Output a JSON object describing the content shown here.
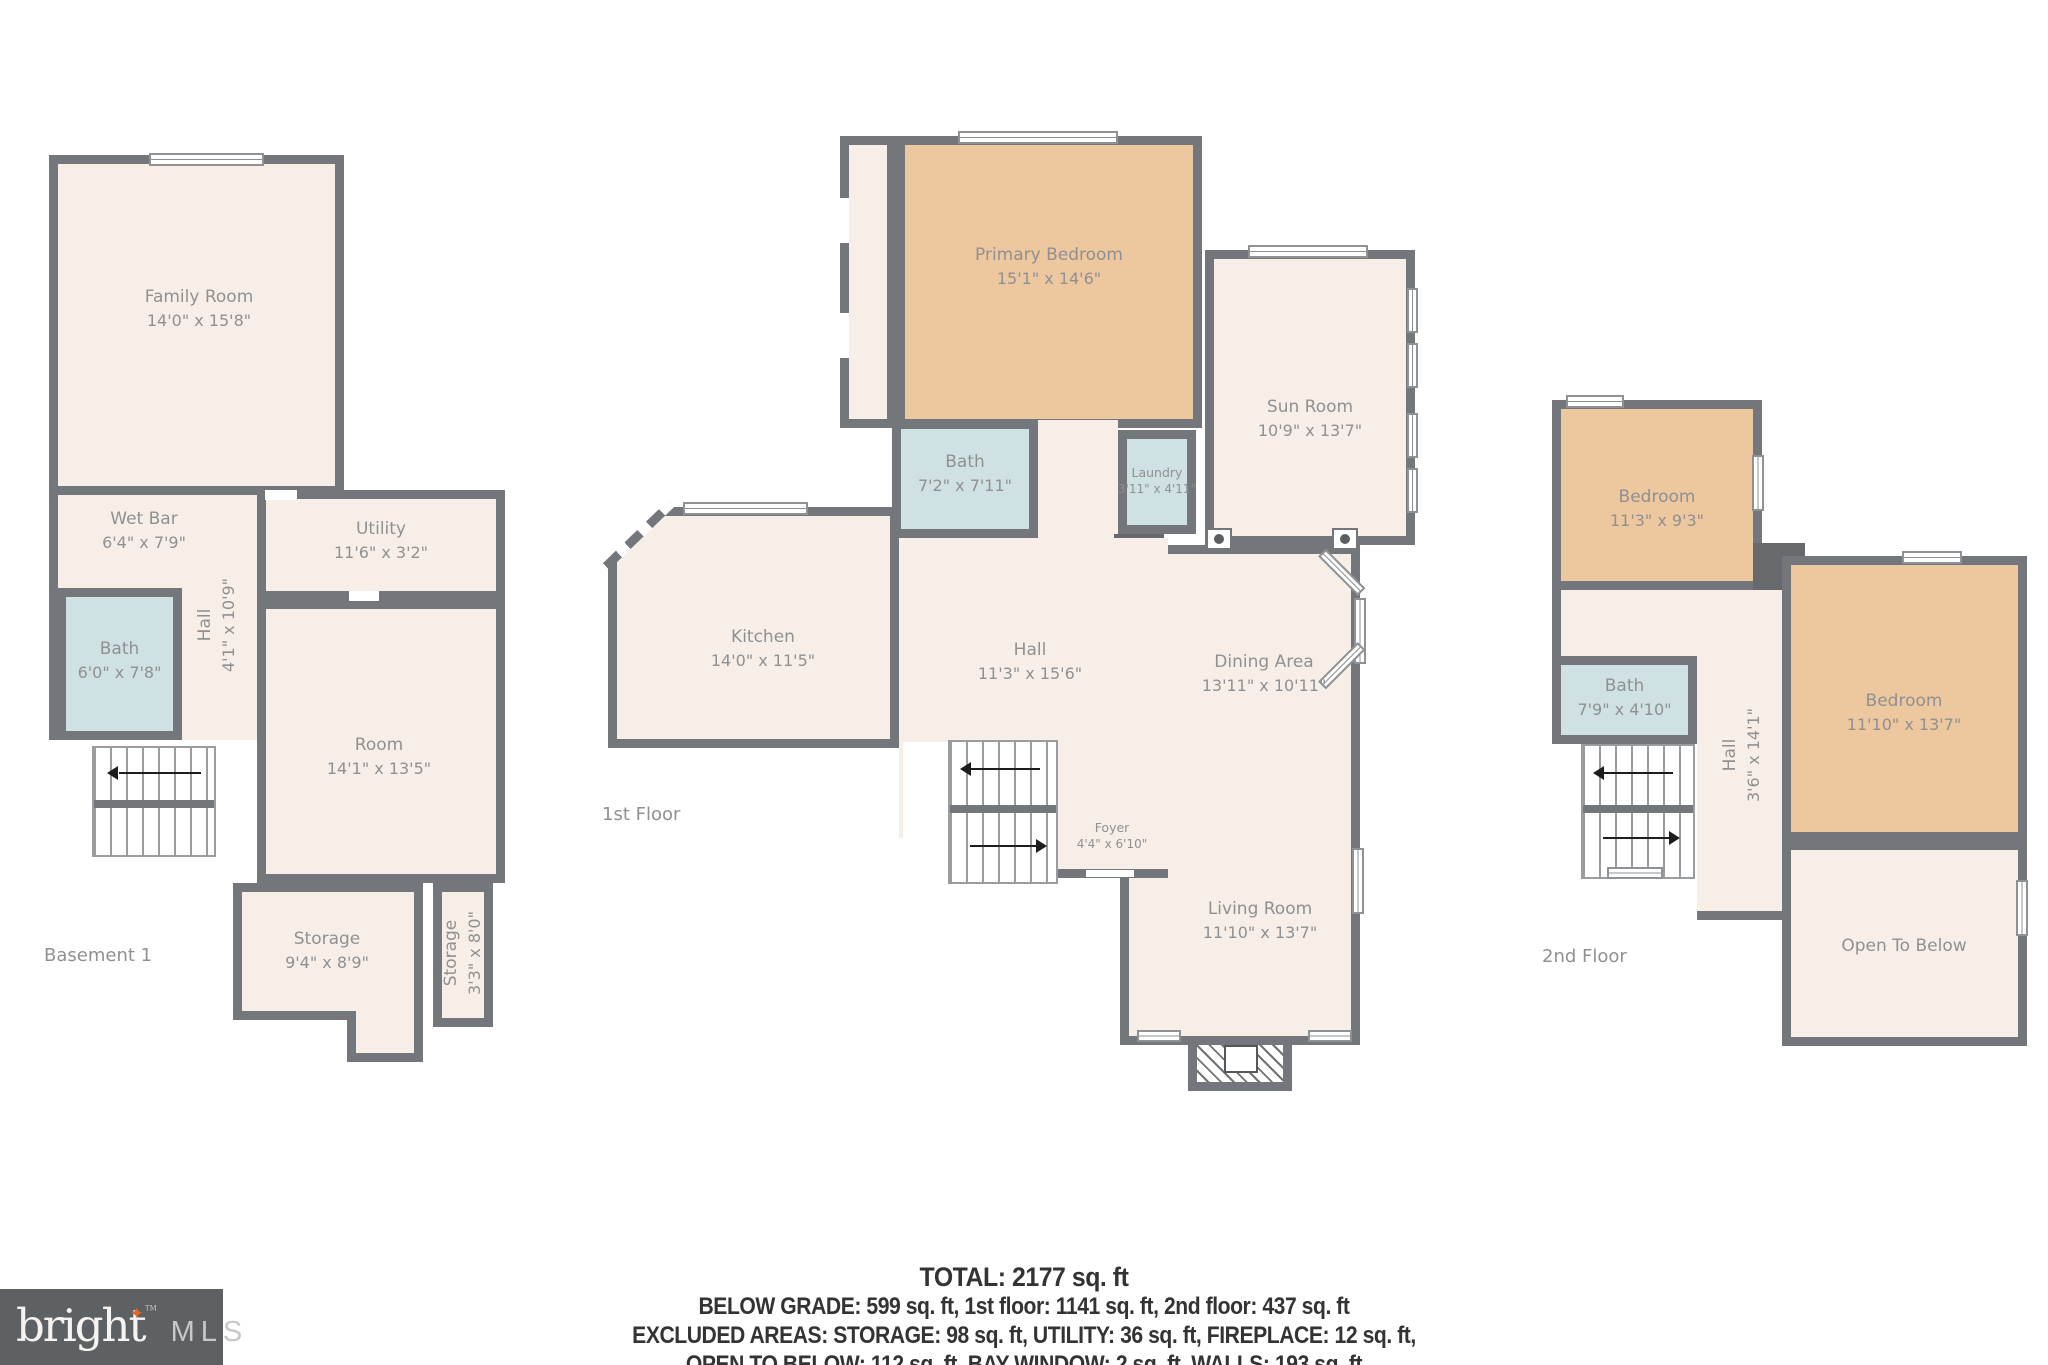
{
  "colors": {
    "wall": "#73767a",
    "floor_fill": "#f7efe7",
    "bedroom_fill": "#edc79e",
    "bath_fill": "#cfe1e3",
    "label_text": "#8f9092",
    "summary_text": "#333333",
    "logo_background": "#5e6164",
    "logo_star": "#e0662a"
  },
  "floors": [
    {
      "label": "Basement 1",
      "rooms": [
        {
          "name": "Family Room",
          "dims": "14'0\" x 15'8\""
        },
        {
          "name": "Wet Bar",
          "dims": "6'4\" x 7'9\""
        },
        {
          "name": "Bath",
          "dims": "6'0\" x 7'8\""
        },
        {
          "name": "Hall",
          "dims": "4'1\" x 10'9\""
        },
        {
          "name": "Utility",
          "dims": "11'6\" x 3'2\""
        },
        {
          "name": "Room",
          "dims": "14'1\" x 13'5\""
        },
        {
          "name": "Storage",
          "dims": "9'4\" x 8'9\""
        },
        {
          "name": "Storage",
          "dims": "3'3\" x 8'0\""
        }
      ]
    },
    {
      "label": "1st Floor",
      "rooms": [
        {
          "name": "Primary Bedroom",
          "dims": "15'1\" x 14'6\""
        },
        {
          "name": "Sun Room",
          "dims": "10'9\" x 13'7\""
        },
        {
          "name": "Laundry",
          "dims": "3'11\" x 4'11\""
        },
        {
          "name": "Bath",
          "dims": "7'2\" x 7'11\""
        },
        {
          "name": "Kitchen",
          "dims": "14'0\" x 11'5\""
        },
        {
          "name": "Hall",
          "dims": "11'3\" x 15'6\""
        },
        {
          "name": "Dining Area",
          "dims": "13'11\" x 10'11\""
        },
        {
          "name": "Foyer",
          "dims": "4'4\" x 6'10\""
        },
        {
          "name": "Living Room",
          "dims": "11'10\" x 13'7\""
        }
      ]
    },
    {
      "label": "2nd Floor",
      "rooms": [
        {
          "name": "Bedroom",
          "dims": "11'3\" x 9'3\""
        },
        {
          "name": "Bath",
          "dims": "7'9\" x 4'10\""
        },
        {
          "name": "Hall",
          "dims": "3'6\" x 14'1\""
        },
        {
          "name": "Bedroom",
          "dims": "11'10\" x 13'7\""
        },
        {
          "name": "Open To Below",
          "dims": ""
        }
      ]
    }
  ],
  "summary": {
    "total": "TOTAL: 2177 sq. ft",
    "lines": [
      "BELOW GRADE: 599 sq. ft, 1st floor: 1141 sq. ft, 2nd floor: 437 sq. ft",
      "EXCLUDED AREAS: STORAGE: 98 sq. ft, UTILITY: 36 sq. ft, FIREPLACE: 12 sq. ft,",
      "OPEN TO BELOW: 112 sq. ft, BAY WINDOW: 2 sq. ft, WALLS: 193 sq. ft"
    ]
  },
  "logo": {
    "brand": "bright",
    "tm": "TM",
    "mls": "MLS",
    "star": "✦"
  }
}
